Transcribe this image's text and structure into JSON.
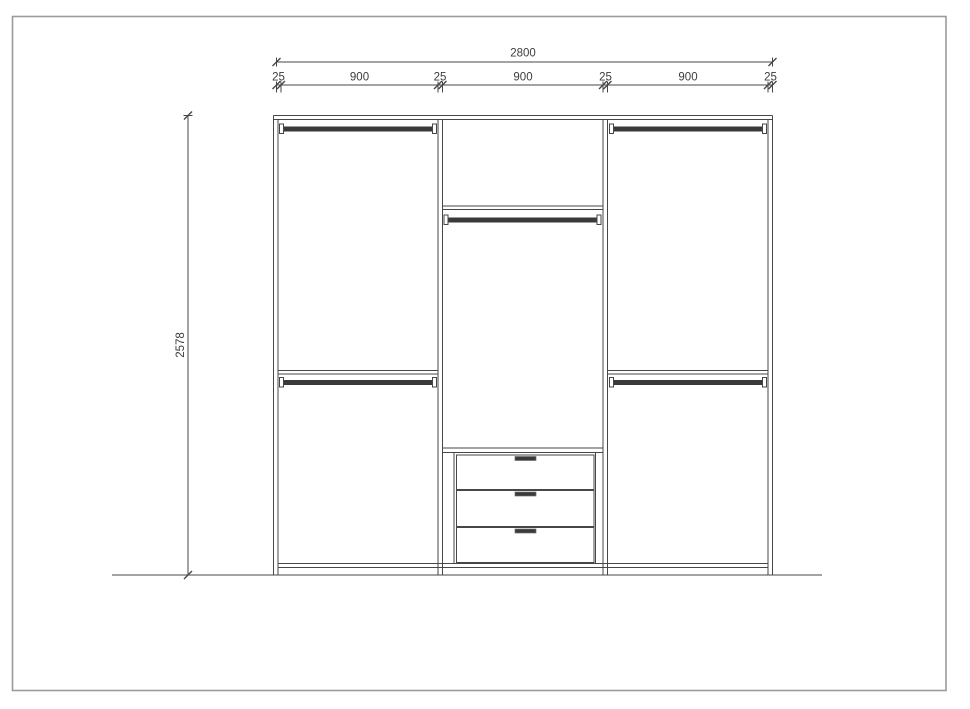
{
  "dimensions": {
    "total_width": "2800",
    "segments": [
      "25",
      "900",
      "25",
      "900",
      "25",
      "900",
      "25"
    ],
    "height": "2578"
  },
  "colors": {
    "line": "#474747",
    "rail_fill": "#3a3a3a",
    "dim_text": "#3c3c3c",
    "canvas_border": "#9b9b9b",
    "background": "#ffffff"
  }
}
